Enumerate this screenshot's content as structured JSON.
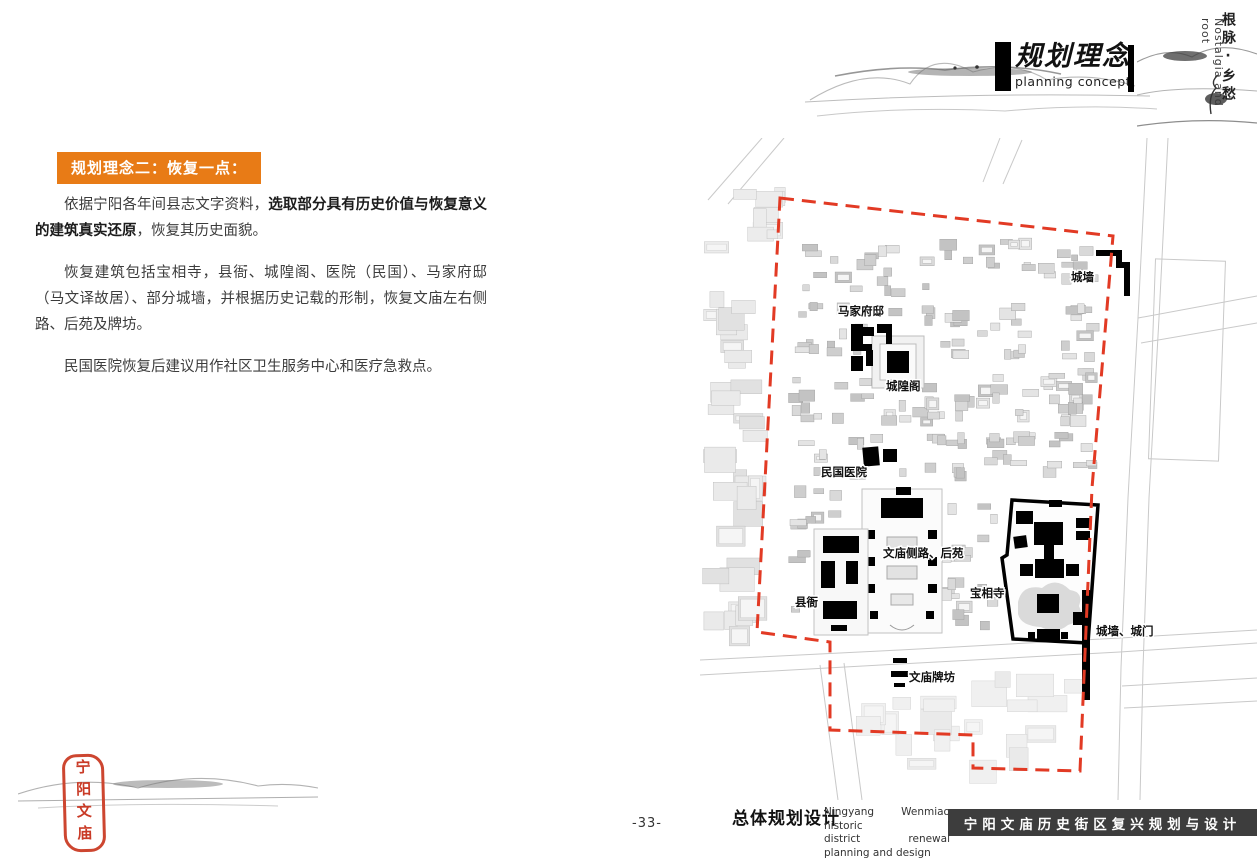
{
  "header": {
    "title_zh": "规划理念",
    "title_en": "planning concept",
    "corner_zh": "根脉·乡愁",
    "corner_en": "Nostalgia and root"
  },
  "content": {
    "banner": "规划理念二：恢复一点：",
    "p1_normal1": "依据宁阳各年间县志文字资料，",
    "p1_bold": "选取部分具有历史价值与恢复意义的建筑真实还原",
    "p1_normal2": "，恢复其历史面貌。",
    "p2": "恢复建筑包括宝相寺，县衙、城隍阁、医院（民国）、马家府邸（马文译故居）、部分城墙，并根据历史记载的形制，恢复文庙左右侧路、后苑及牌坊。",
    "p3": "民国医院恢复后建议用作社区卫生服务中心和医疗急救点。"
  },
  "map": {
    "labels": {
      "chengqiang": "城墙",
      "majiafudi": "马家府邸",
      "chenghuangge": "城隍阁",
      "minguoyiyuan": "民国医院",
      "wenmiaocelu": "文庙侧路、后苑",
      "xianya": "县衙",
      "baoxiangsi": "宝相寺",
      "chengqiang_chengmen": "城墙、城门",
      "wenmiaopaifang": "文庙牌坊"
    }
  },
  "footer": {
    "page_number": "-33-",
    "title_zh": "总体规划设计",
    "subtitle_en_line1": "Ningyang Wenmiao historic",
    "subtitle_en_line2": "district renewal planning and design",
    "bar_text": "宁阳文庙历史街区复兴规划与设计",
    "seal_text": "宁阳文庙"
  },
  "colors": {
    "banner_orange": "#e87b16",
    "boundary_red": "#e23a24",
    "seal_red": "#c93a26",
    "footer_bar": "#3d3d3d"
  }
}
